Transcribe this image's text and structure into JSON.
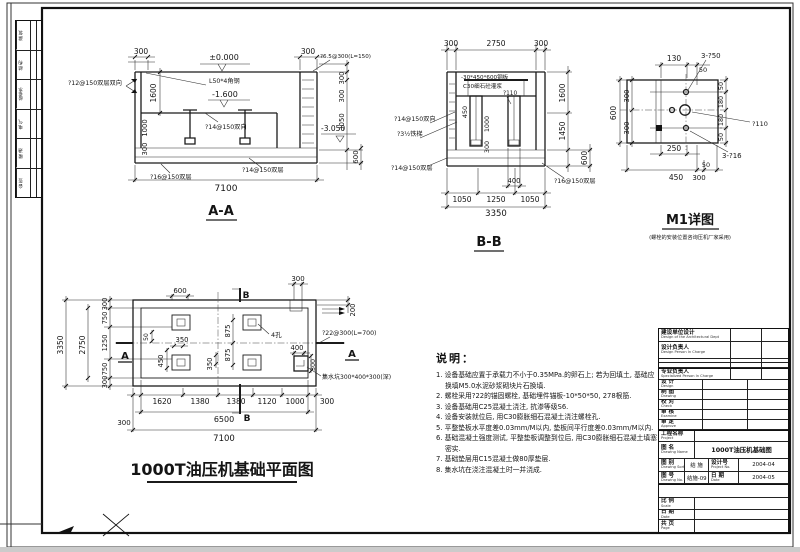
{
  "dims": {
    "n50": "50",
    "n130": "130",
    "n180": "180",
    "n200": "200",
    "n250": "250",
    "n300": "300",
    "n350": "350",
    "n400": "400",
    "n450": "450",
    "n600": "600",
    "n750": "750",
    "n875": "875",
    "n1000": "1000",
    "n1050": "1050",
    "n1120": "1120",
    "n1250": "1250",
    "n1380": "1380",
    "n1450": "1450",
    "n1600": "1600",
    "n1620": "1620",
    "n2750": "2750",
    "n3050": "3050",
    "n3350": "3350",
    "n6500": "6500",
    "n7100": "7100"
  },
  "levels": {
    "zero": "±0.000",
    "m1600": "-1.600",
    "m3050": "-3.050"
  },
  "rebar": {
    "r12": "?12@150双层双向",
    "r14w": "?14@150双向",
    "r14s": "?14@150双层",
    "r16s": "?16@150双层",
    "r65": "?6.5@300(L=150)",
    "r22": "?22@300(L=700)",
    "angle": "L50*4角钢",
    "ladder": "?3½铁梯",
    "plate": "-30*450*600钢板",
    "grout": "C30细石砼灌浆",
    "d110": "?110",
    "b50": "3-?50",
    "b16": "3-?16",
    "sump": "集水坑300*400*300(深)",
    "holes": "4孔"
  },
  "aa": {
    "title": "A-A"
  },
  "bb": {
    "title": "B-B"
  },
  "m1": {
    "title": "M1详图",
    "subtitle": "(螺栓的安装位置咨询压机厂家采用)"
  },
  "plan": {
    "title": "1000T油压机基础平面图",
    "mark_a": "A",
    "mark_b": "B"
  },
  "notes": {
    "heading": "说明：",
    "items": [
      "1. 设备基础应置于承载力不小于0.35MPa.的卵石上; 若为回填土, 基础应换填M5.0水泥砂浆砌块片石换填.",
      "2. 螺栓采用?22的锚固螺栓, 基础埋件锚板-10*50*50, 278根筋.",
      "3. 设备基础用C25混凝土浇注, 抗渗等级S6.",
      "4. 设备安装就位后, 用C30膨胀细石混凝土浇注螺栓孔.",
      "5. 平整垫板水平度差0.03mm/M以内, 垫板间平行度差0.03mm/M以内.",
      "6. 基础混凝土强度测试, 平整垫板调整到位后, 用C30膨胀细石混凝土填塞密实.",
      "7. 基础垫层用C15混凝土做80厚垫层.",
      "8. 集水坑在浇注混凝土时一并浇成."
    ]
  },
  "titleblock": {
    "unit_zh": "建设单位设计",
    "unit_en": "Design of the Architectural Dept",
    "resp_zh": "设计负责人",
    "resp_en": "Design Person In Charge",
    "spec_zh": "专业负责人",
    "spec_en": "Specialized Person In Charge",
    "design_zh": "设 计",
    "design_en": "Design",
    "draft_zh": "制 图",
    "draft_en": "Drawing",
    "check_zh": "校 对",
    "check_en": "Check",
    "exam_zh": "审 核",
    "exam_en": "Examine",
    "appr_zh": "审 定",
    "appr_en": "Approve",
    "proj_zh": "工程名称",
    "proj_en": "Project",
    "dwgname_zh": "图 名",
    "dwgname_en": "Drawing Name",
    "dwgname_val": "1000T油压机基础图",
    "sort_zh": "图 别",
    "sort_en": "Drawing Sort",
    "sort_val": "结 施",
    "projno_zh": "设计号",
    "projno_en": "Project No.",
    "projno_val": "2004-04",
    "no_zh": "图 号",
    "no_en": "Drawing No.",
    "no_val": "结施-09",
    "date_zh": "日 期",
    "date_en": "Date",
    "date_val": "2004-05",
    "scale_zh": "比 例",
    "scale_en": "Scale",
    "date2_zh": "日 期",
    "date2_en": "Date",
    "page_zh": "共 页",
    "page_en": "Page"
  },
  "sign_strip": {
    "rows": [
      "建 筑",
      "结 构",
      "给排水",
      "电 气",
      "暖 通",
      "会 签"
    ]
  }
}
